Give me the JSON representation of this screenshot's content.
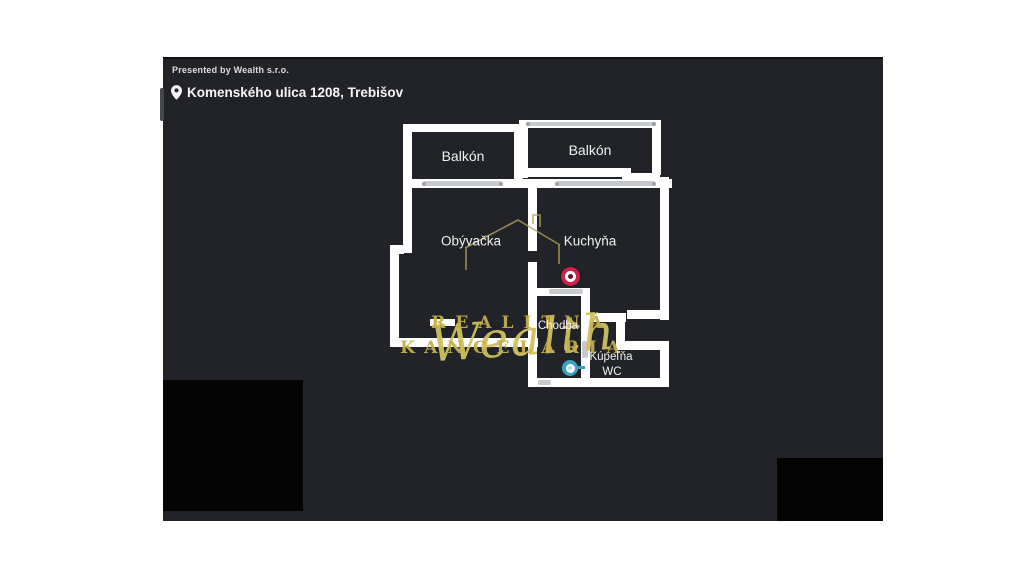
{
  "header": {
    "presented_by": "Presented by Wealth s.r.o.",
    "address": "Komenského ulica 1208, Trebišov"
  },
  "plan": {
    "rooms": {
      "balkon_left": "Balkón",
      "balkon_right": "Balkón",
      "obyvacka": "Obývačka",
      "kuchyna": "Kuchyňa",
      "chodba": "Chodba",
      "kupelna": "Kúpeľňa",
      "wc": "WC"
    },
    "watermark": {
      "brand": "Wealth",
      "line1": "REALITNÁ",
      "line2": "KANCELÁRIA"
    }
  },
  "colors": {
    "panel_bg": "#212329",
    "wall": "#ffffff",
    "gold": "#c4b151",
    "label": "#eef0f2",
    "window_line": "#c7cacd",
    "window_dot": "#9aa0a5",
    "marker_red": "#c9234a",
    "marker_red_center": "#6e1230",
    "marker_teal": "#37a6bc",
    "marker_teal_center": "#aadfeb",
    "black_patch": "#040404"
  }
}
